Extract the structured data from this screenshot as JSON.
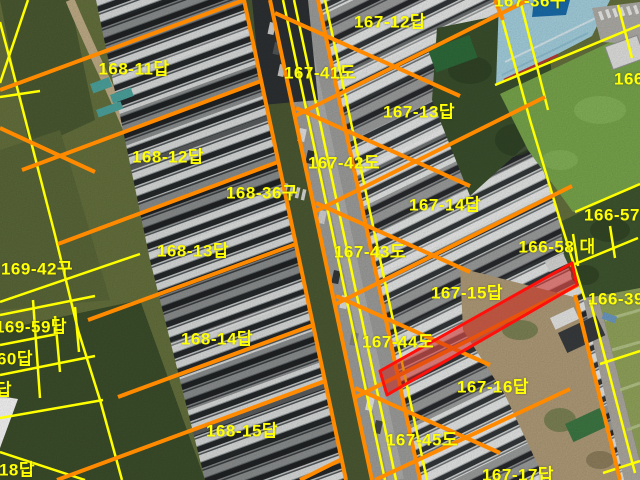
{
  "map": {
    "type": "cadastral-aerial-overlay",
    "colors": {
      "boundary_major": "#ff8a00",
      "boundary_minor": "#ffff00",
      "label_text": "#ffff05",
      "highlight_stroke": "#ff100a",
      "highlight_fill": "rgba(210,25,20,0.5)"
    },
    "labels": [
      {
        "text": "168-11답",
        "x": 134,
        "y": 69
      },
      {
        "text": "168-12답",
        "x": 168,
        "y": 157
      },
      {
        "text": "168-36구",
        "x": 262,
        "y": 193
      },
      {
        "text": "168-13답",
        "x": 193,
        "y": 251
      },
      {
        "text": "168-14답",
        "x": 217,
        "y": 339
      },
      {
        "text": "168-15답",
        "x": 242,
        "y": 431
      },
      {
        "text": "169-42구",
        "x": 37,
        "y": 269
      },
      {
        "text": "169-59답",
        "x": 31,
        "y": 327
      },
      {
        "text": "60답",
        "x": 15,
        "y": 359
      },
      {
        "text": "답",
        "x": 4,
        "y": 390
      },
      {
        "text": "18답",
        "x": 17,
        "y": 470
      },
      {
        "text": "167-12답",
        "x": 390,
        "y": 22
      },
      {
        "text": "167-41도",
        "x": 320,
        "y": 73
      },
      {
        "text": "167-13답",
        "x": 419,
        "y": 112
      },
      {
        "text": "167-42도",
        "x": 344,
        "y": 163
      },
      {
        "text": "167-14답",
        "x": 445,
        "y": 205
      },
      {
        "text": "167-43도",
        "x": 370,
        "y": 252
      },
      {
        "text": "167-15답",
        "x": 467,
        "y": 293
      },
      {
        "text": "167-44도",
        "x": 398,
        "y": 342
      },
      {
        "text": "167-16답",
        "x": 493,
        "y": 387
      },
      {
        "text": "167-45도",
        "x": 422,
        "y": 440
      },
      {
        "text": "167-17답",
        "x": 518,
        "y": 475
      },
      {
        "text": "166-58 대",
        "x": 557,
        "y": 247
      },
      {
        "text": "166-57",
        "x": 612,
        "y": 215
      },
      {
        "text": "166-39",
        "x": 616,
        "y": 299
      },
      {
        "text": "166-",
        "x": 632,
        "y": 79
      },
      {
        "text": "167-36구",
        "x": 530,
        "y": 1
      }
    ],
    "highlighted_parcel": {
      "polygon": [
        [
          572,
          263
        ],
        [
          577,
          285
        ],
        [
          387,
          395
        ],
        [
          380,
          371
        ]
      ]
    }
  }
}
